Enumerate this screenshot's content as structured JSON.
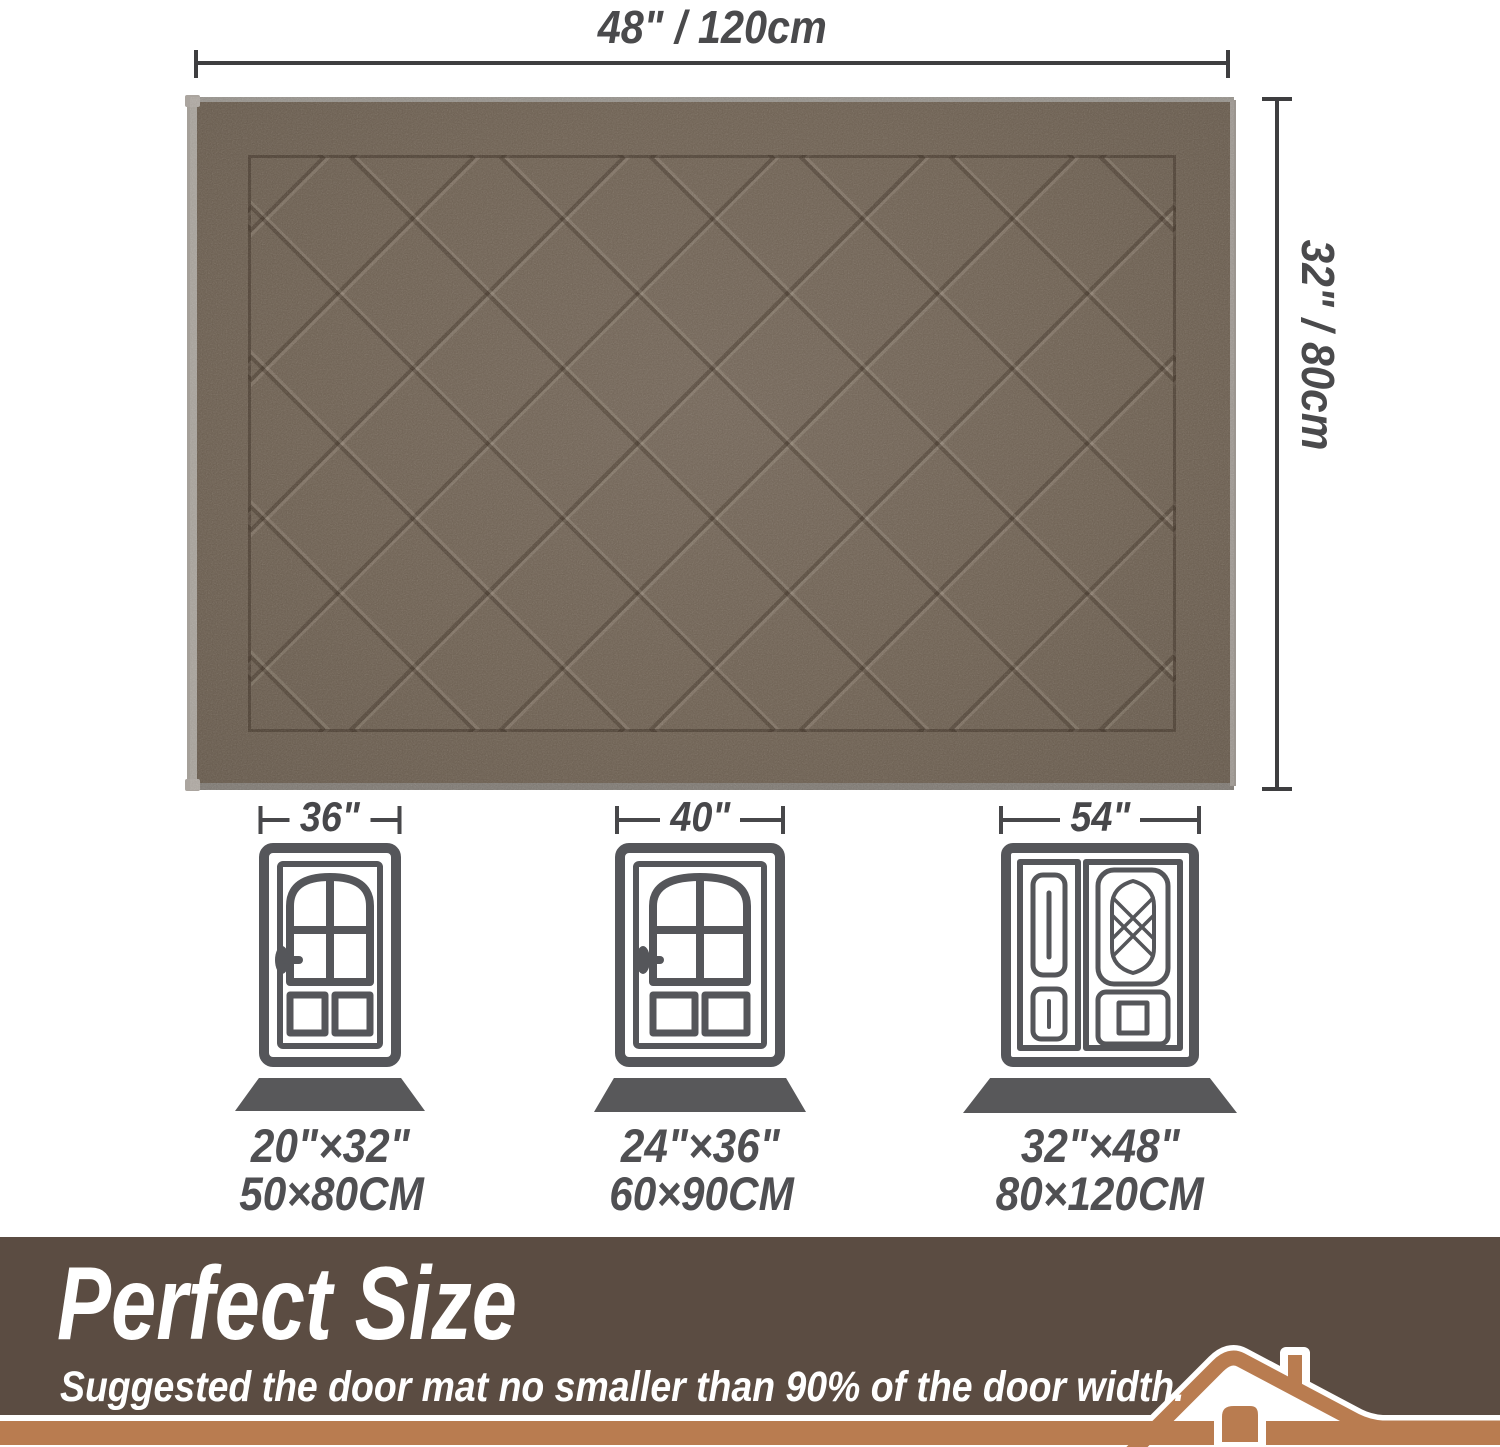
{
  "diagram": {
    "top_dimension": "48\" / 120cm",
    "side_dimension": "32\" / 80cm"
  },
  "mat": {
    "description": "brown diamond-pattern door mat",
    "base_color": "#6e6153",
    "groove_color": "#4e4236",
    "binding_color": "#a5a099"
  },
  "doors": [
    {
      "width_label": "36\"",
      "mat_inches": "20\"×32\"",
      "mat_cm": "50×80CM",
      "type": "single"
    },
    {
      "width_label": "40\"",
      "mat_inches": "24\"×36\"",
      "mat_cm": "60×90CM",
      "type": "single"
    },
    {
      "width_label": "54\"",
      "mat_inches": "32\"×48\"",
      "mat_cm": "80×120CM",
      "type": "double"
    }
  ],
  "banner": {
    "title": "Perfect Size",
    "subtitle": "Suggested the door mat no smaller than 90% of the door width.",
    "band_color": "#5b4c42",
    "accent_color": "#b97c50",
    "text_color": "#ffffff"
  }
}
